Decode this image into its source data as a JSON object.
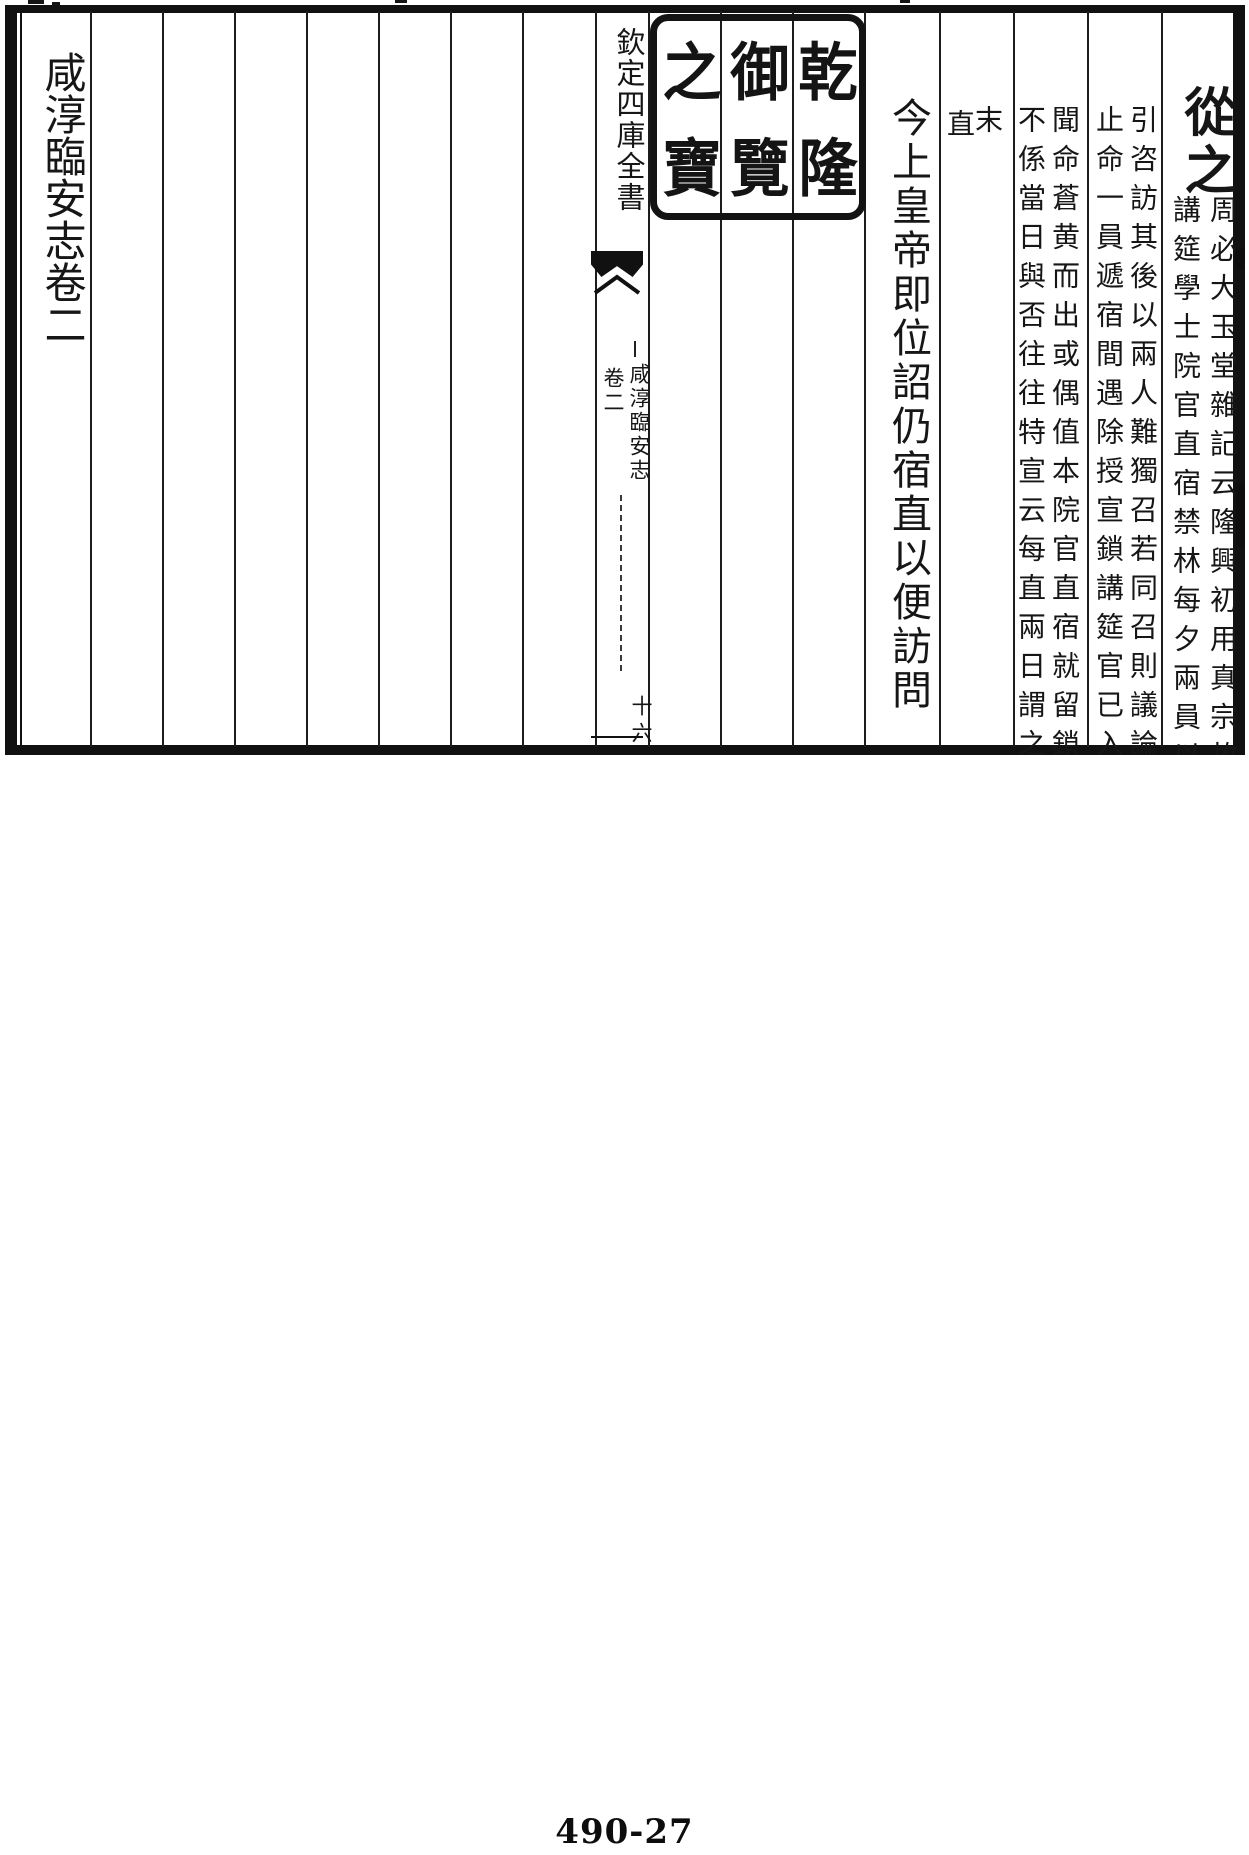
{
  "bottom_label": "490-27",
  "book_page": {
    "left_title": "咸淳臨安志卷二",
    "spine": {
      "header": "欽定四庫全書",
      "book_title": "咸淳臨安志",
      "chapter": "卷二",
      "folio": "十六"
    },
    "seal": {
      "name": "乾隆御覽之寶",
      "chars": [
        "乾",
        "隆",
        "御",
        "覽",
        "之",
        "寶"
      ]
    },
    "main": {
      "verdict": "從之",
      "proclamation": "今上皇帝即位詔仍宿直以便訪問"
    },
    "annotations": [
      {
        "right": "周必大玉堂雜記云隆興初用真宗故",
        "left": "講筵學士院官直宿禁林每夕兩員以"
      },
      {
        "right": "引咨訪其後以兩人難獨召若同召則議論",
        "left": "止命一員遞宿間遇除授宣鎖講筵官已入"
      },
      {
        "right": "聞命蒼黄而出或偶值本院官直宿就留鎖",
        "left": "不係當日與否往往特宣云每直兩日謂之"
      },
      {
        "right": "末",
        "left": "直"
      }
    ]
  }
}
